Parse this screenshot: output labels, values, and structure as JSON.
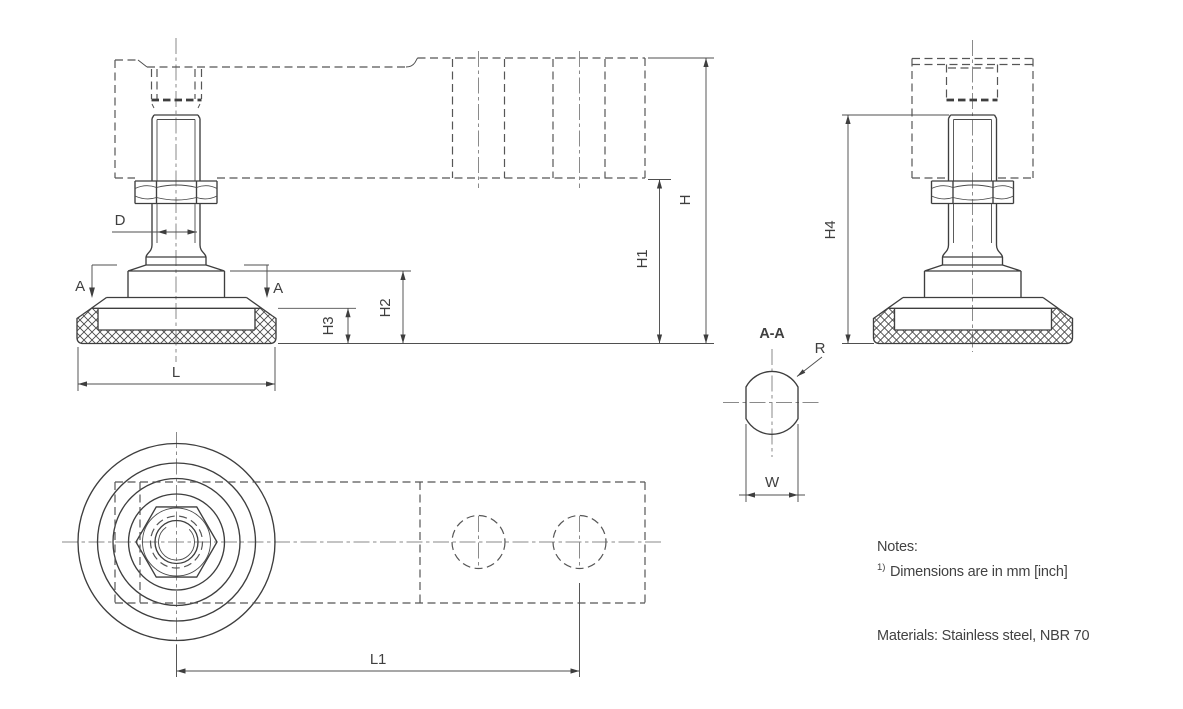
{
  "drawing": {
    "title": "leveling-foot-technical-drawing",
    "labels": {
      "d": "D",
      "a_left": "A",
      "a_right": "A",
      "h": "H",
      "h1": "H1",
      "h2": "H2",
      "h3": "H3",
      "h4": "H4",
      "l": "L",
      "l1": "L1",
      "w": "W",
      "r": "R",
      "section": "A-A"
    },
    "notes": {
      "heading": "Notes:",
      "note1_marker": "1)",
      "note1": "Dimensions are in mm [inch]",
      "materials": "Materials: Stainless steel, NBR 70"
    },
    "colors": {
      "line": "#3e3e3e",
      "dashed_line": "#565656",
      "centerline": "#8a8a8a",
      "text": "#3f3f3f",
      "background": "#ffffff"
    }
  }
}
